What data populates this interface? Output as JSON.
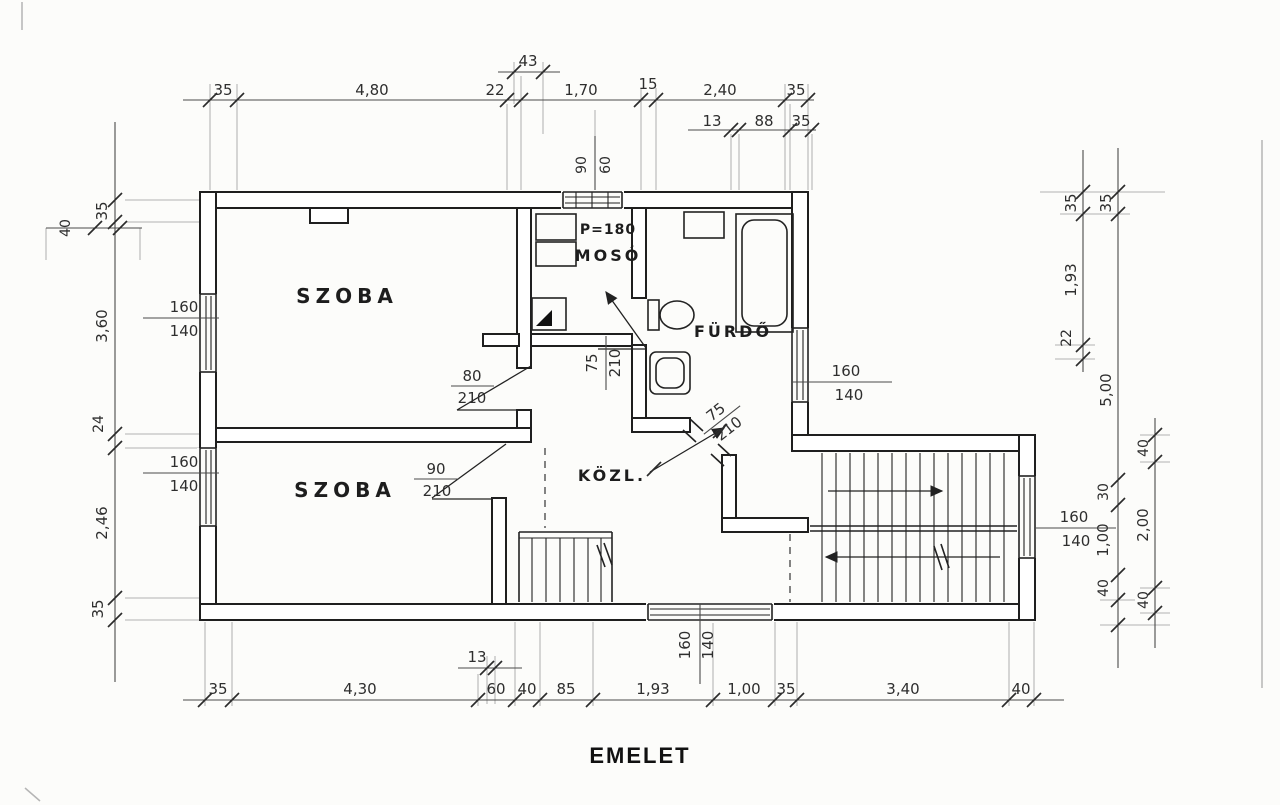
{
  "title": "EMELET",
  "colors": {
    "paper": "#fcfcfa",
    "ink": "#1f1f1f",
    "dim_text": "#2e2e2e"
  },
  "rooms": {
    "szoba_top": "SZOBA",
    "szoba_bottom": "SZOBA",
    "moso": "MOSÓ",
    "p_label": "P=180",
    "furdo": "FÜRDŐ",
    "kozl": "KÖZL."
  },
  "dims": {
    "top": [
      "35",
      "4,80",
      "22",
      "1,70",
      "15",
      "2,40",
      "35"
    ],
    "top_raised": "43",
    "top_sub": [
      "13",
      "88",
      "35"
    ],
    "top_door": [
      "90",
      "60"
    ],
    "left": [
      "40",
      "35",
      "3,60",
      "24",
      "2,46",
      "35"
    ],
    "right_a": [
      "35",
      "1,93",
      "22"
    ],
    "right_b": [
      "35",
      "5,00",
      "30",
      "1,00",
      "40"
    ],
    "right_c": [
      "40",
      "2,00",
      "40"
    ],
    "bottom": [
      "35",
      "4,30",
      "60",
      "40",
      "85",
      "1,93",
      "1,00",
      "35",
      "3,40",
      "40"
    ],
    "bottom_raised": "13"
  },
  "openings": {
    "door_szoba_top": {
      "num": "80",
      "den": "210"
    },
    "door_szoba_bottom": {
      "num": "90",
      "den": "210"
    },
    "door_furdo": {
      "num": "75",
      "den": "210"
    },
    "door_kozl": {
      "num": "75",
      "den": "210"
    },
    "win_left_top": {
      "num": "160",
      "den": "140"
    },
    "win_left_bottom": {
      "num": "160",
      "den": "140"
    },
    "win_furdo": {
      "num": "160",
      "den": "140"
    },
    "win_stair": {
      "num": "160",
      "den": "140"
    },
    "win_bottom": {
      "num": "160",
      "den": "140"
    }
  }
}
